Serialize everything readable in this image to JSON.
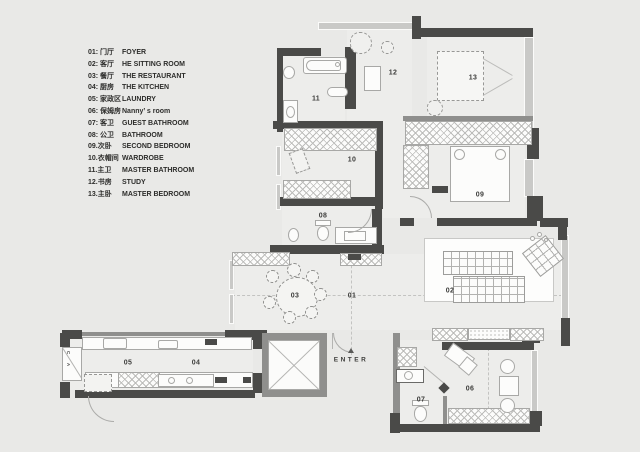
{
  "colors": {
    "background": "#e9e9e7",
    "wall_dark": "#4a4a48",
    "wall_medium": "#8f8f8d",
    "window_light": "#c9c9c7",
    "floor": "#ededeb",
    "furniture_fill": "#fcfcfb",
    "line": "#a8a8a6",
    "text": "#333331"
  },
  "rooms": {
    "items": [
      {
        "num": "01",
        "label_zh": "01: 门厅",
        "label_en": "FOYER"
      },
      {
        "num": "02",
        "label_zh": "02: 客厅",
        "label_en": "HE SITTING ROOM"
      },
      {
        "num": "03",
        "label_zh": "03: 餐厅",
        "label_en": "THE RESTAURANT"
      },
      {
        "num": "04",
        "label_zh": "04: 厨房",
        "label_en": "THE KITCHEN"
      },
      {
        "num": "05",
        "label_zh": "05: 家政区",
        "label_en": "LAUNDRY"
      },
      {
        "num": "06",
        "label_zh": "06: 保姆房",
        "label_en": "Nanny’ s room"
      },
      {
        "num": "07",
        "label_zh": "07: 客卫",
        "label_en": "GUEST BATHROOM"
      },
      {
        "num": "08",
        "label_zh": "08: 公卫",
        "label_en": "BATHROOM"
      },
      {
        "num": "09",
        "label_zh": "09.次卧",
        "label_en": "SECOND BEDROOM"
      },
      {
        "num": "10",
        "label_zh": "10.衣帽间",
        "label_en": "WARDROBE"
      },
      {
        "num": "11",
        "label_zh": "11.主卫",
        "label_en": "MASTER BATHROOM"
      },
      {
        "num": "12",
        "label_zh": "12.书房",
        "label_en": "STUDY"
      },
      {
        "num": "13",
        "label_zh": "13.主卧",
        "label_en": "MASTER BEDROOM"
      }
    ]
  },
  "plan": {
    "enter_label": "ENTER",
    "washer_labels": [
      "C",
      "A"
    ]
  }
}
